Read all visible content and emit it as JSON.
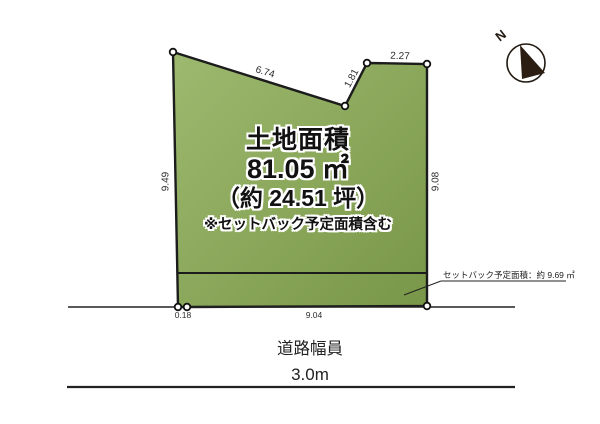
{
  "labels": {
    "area_title": "土地面積",
    "area_m2": "81.05 ㎡",
    "area_tsubo": "（約 24.51 坪）",
    "area_note": "※セットバック予定面積含む",
    "setback_note": "セットバック予定面積：約 9.69 ㎡",
    "road_label": "道路幅員",
    "road_width": "3.0m",
    "north": "N"
  },
  "dimensions": {
    "top_edge": "6.74",
    "notch_edge": "1.81",
    "top_right_edge": "2.27",
    "left_edge": "9.49",
    "right_edge": "9.08",
    "bottom_offset": "0.18",
    "frontage": "9.04"
  },
  "colors": {
    "land_fill_light": "#9db96f",
    "land_fill_dark": "#799748",
    "outline": "#1c1c1c",
    "needle": "#2b1d12"
  }
}
